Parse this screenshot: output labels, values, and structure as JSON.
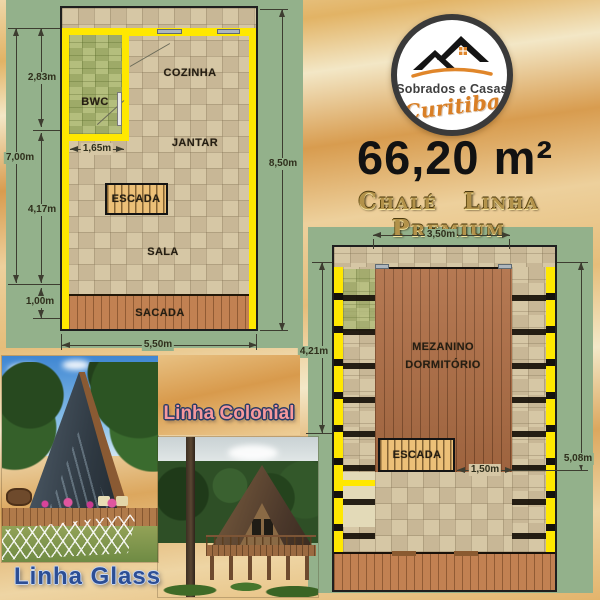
{
  "poster": {
    "logo": {
      "line1": "Sobrados e Casas",
      "line2": "Curitiba"
    },
    "area_label": "66,20 m²",
    "series_label": "Chalé Linha Premium"
  },
  "floor_plan_ground": {
    "rooms": {
      "bwc": "BWC",
      "kitchen": "COZINHA",
      "dining": "JANTAR",
      "stairs": "ESCADA",
      "living": "SALA",
      "balcony": "SACADA"
    },
    "dims": {
      "bwc_height": "2,83m",
      "bwc_width": "1,65m",
      "total_height": "7,00m",
      "living_height": "4,17m",
      "balcony_depth": "1,00m",
      "width": "5,50m",
      "total_depth": "8,50m"
    }
  },
  "floor_plan_upper": {
    "rooms": {
      "mezzanine_line1": "MEZANINO",
      "mezzanine_line2": "DORMITÓRIO",
      "stairs": "ESCADA"
    },
    "dims": {
      "width": "3,50m",
      "left_height": "4,21m",
      "right_height": "5,08m",
      "stairs_width": "1,50m"
    }
  },
  "photos": {
    "glass": {
      "caption": "Linha Glass"
    },
    "colonial": {
      "caption": "Linha Colonial"
    }
  },
  "colors": {
    "panel_green": "#93b18b",
    "wall_yellow": "#ffe800",
    "sand_mid": "#dfae63",
    "logo_orange": "#d97f26",
    "gold": "#b3924a",
    "caption_glass": "#2c4e95",
    "caption_colonial": "#f6989d"
  }
}
